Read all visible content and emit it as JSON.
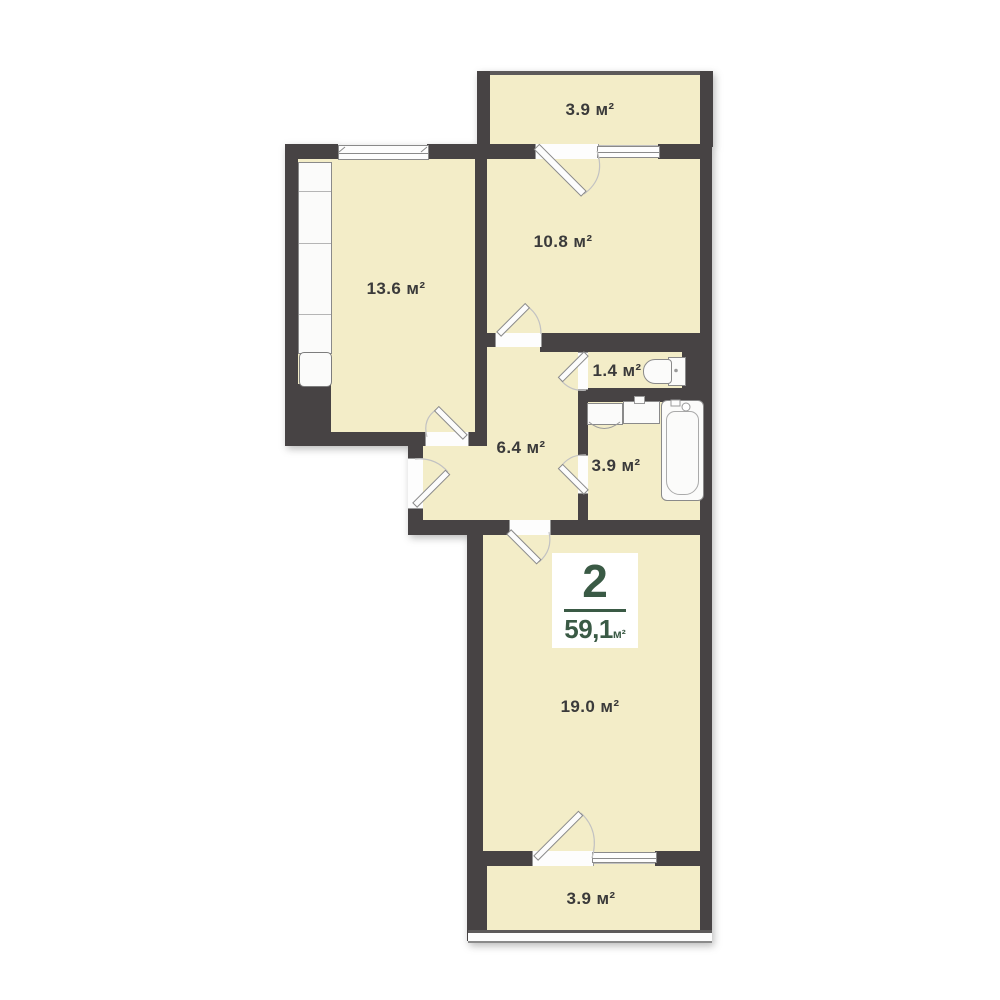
{
  "badge": {
    "rooms_count": "2",
    "total_area": "59,1",
    "area_unit": "м²"
  },
  "rooms": {
    "balcony_top": {
      "area_label": "3.9 м²"
    },
    "kitchen": {
      "area_label": "13.6 м²"
    },
    "bedroom": {
      "area_label": "10.8 м²"
    },
    "wc": {
      "area_label": "1.4 м²"
    },
    "hallway": {
      "area_label": "6.4 м²"
    },
    "bathroom": {
      "area_label": "3.9 м²"
    },
    "living_room": {
      "area_label": "19.0 м²"
    },
    "balcony_bottom": {
      "area_label": "3.9 м²"
    }
  },
  "fixtures": [
    "kitchen-counter",
    "kitchen-sink",
    "toilet",
    "washing-machine",
    "bathroom-sink",
    "bathtub"
  ],
  "colors": {
    "wall": "#474344",
    "fill": "#f3edc8",
    "accent": "#3a5a45",
    "text": "#3a3a3a"
  }
}
